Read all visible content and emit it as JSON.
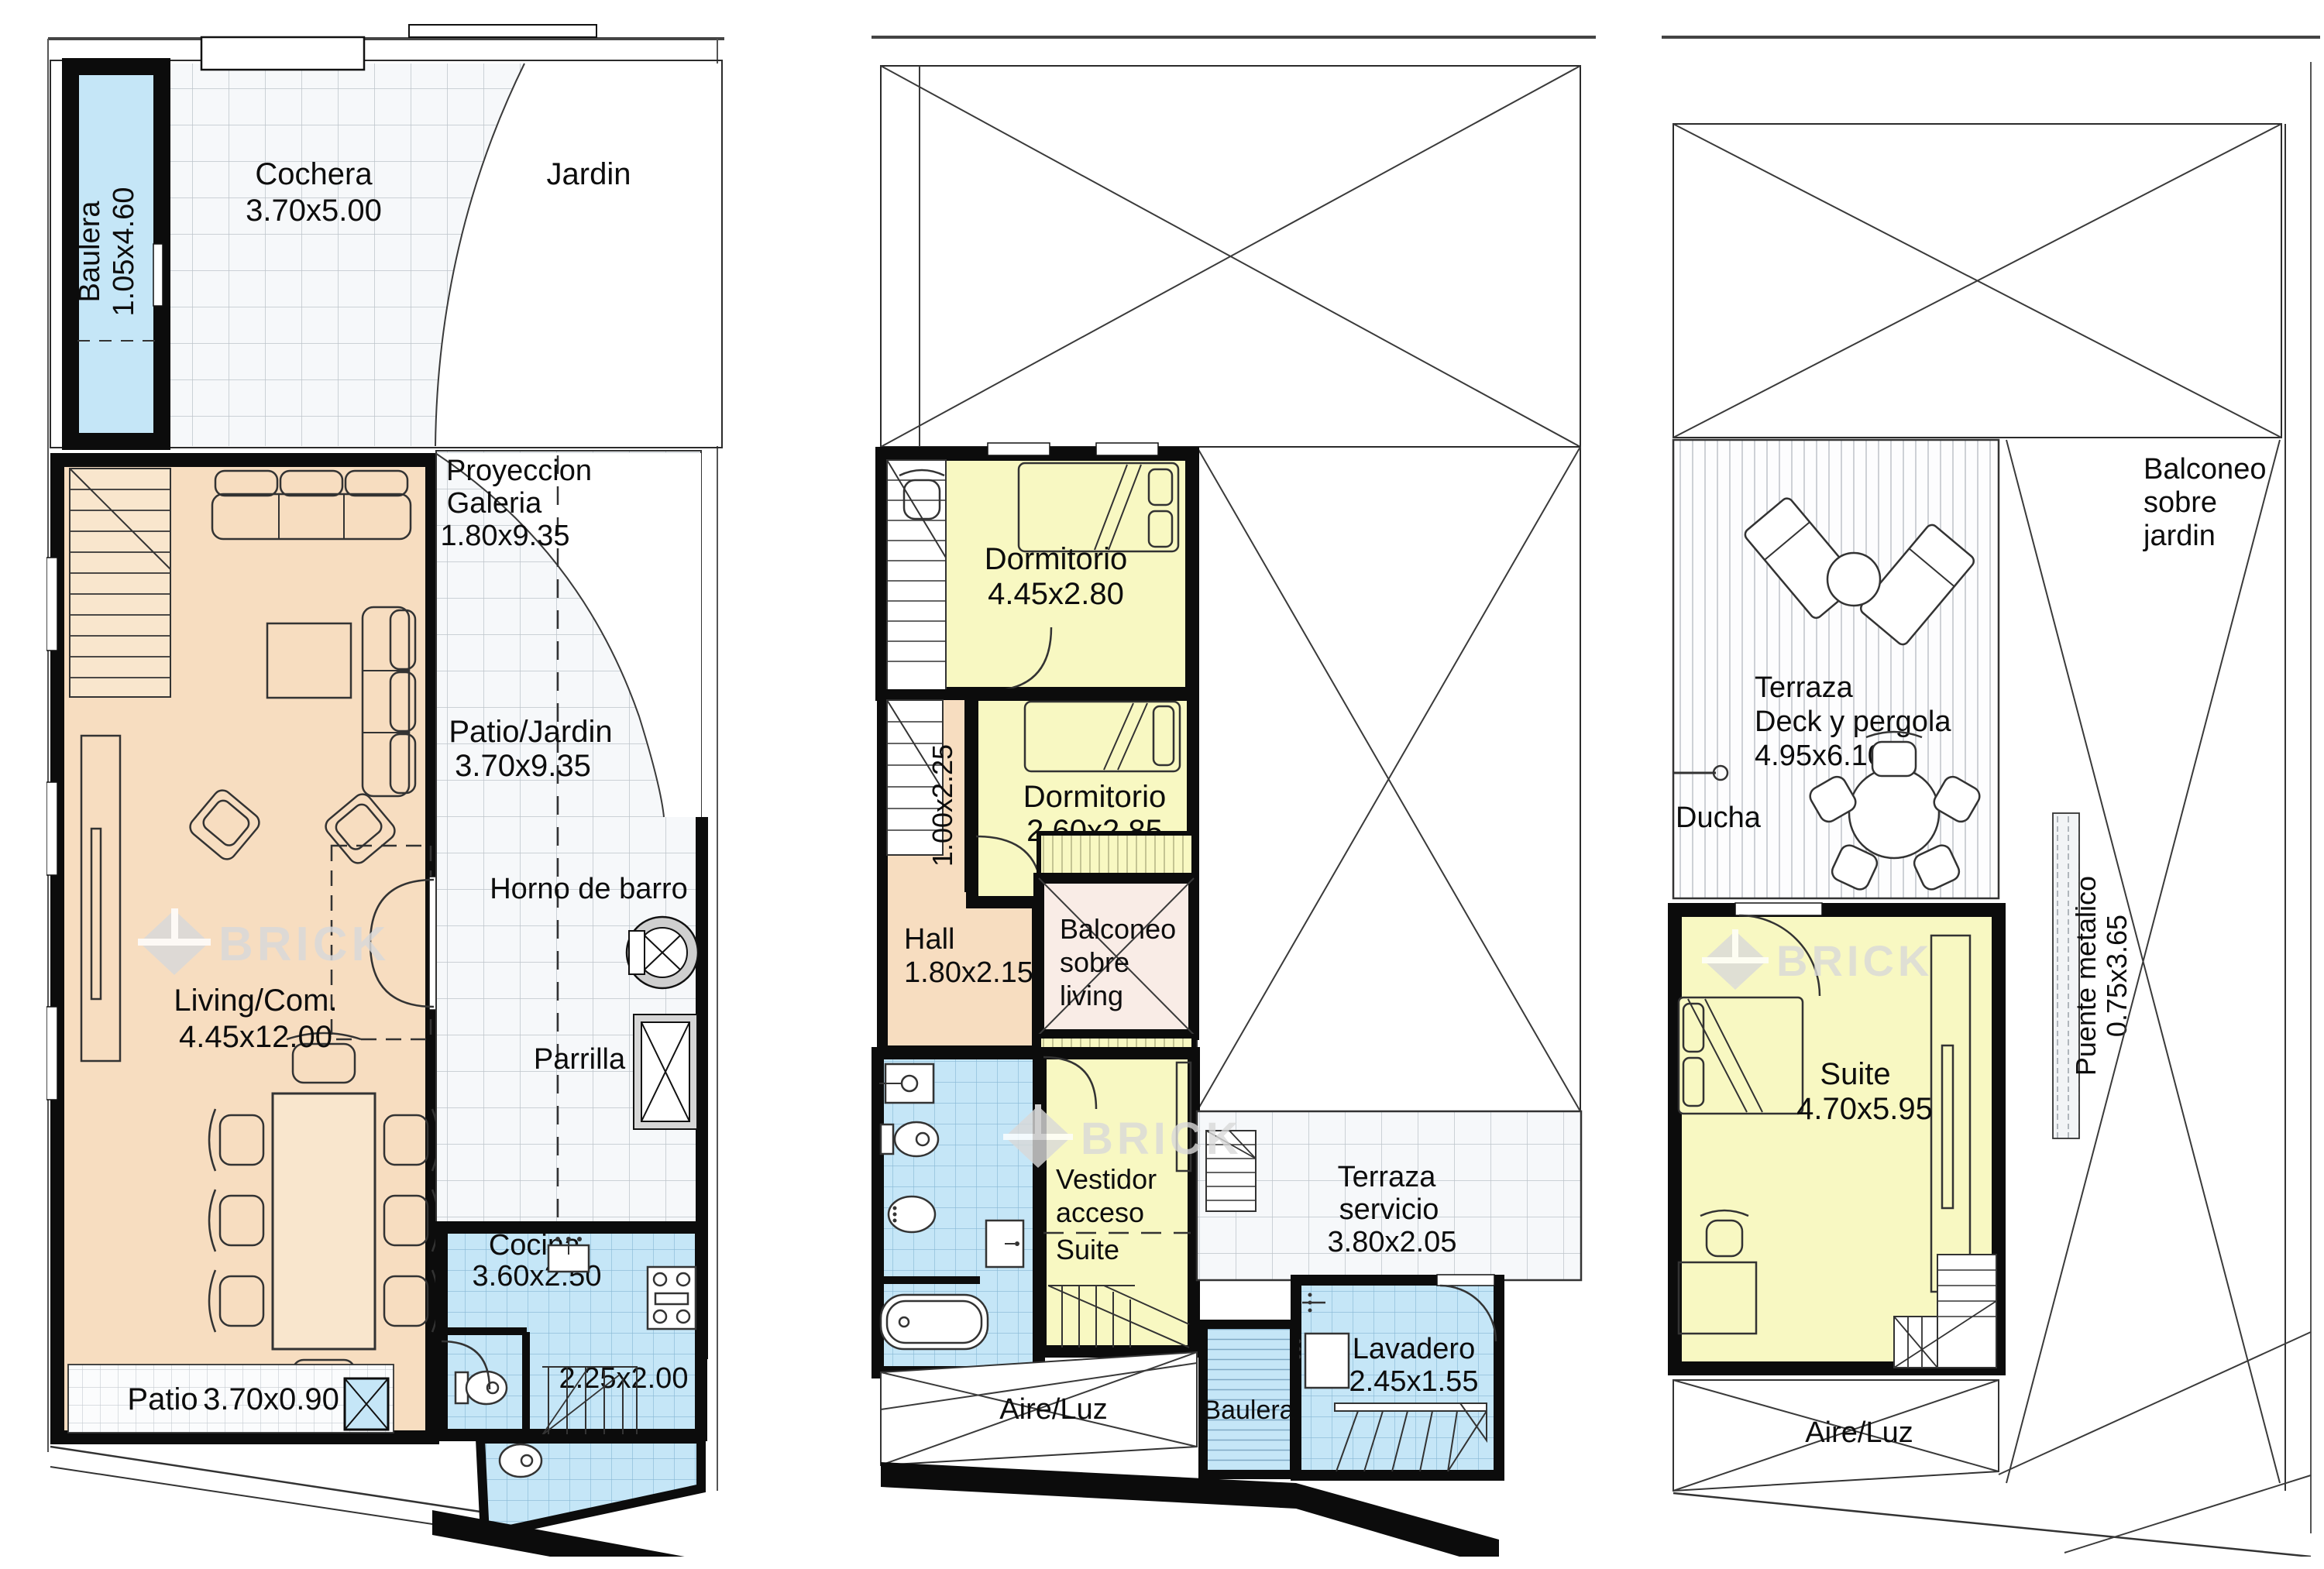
{
  "title": "Floor plans (3 levels) - BRICK",
  "watermark": "BRICK",
  "colors": {
    "wall": "#0c0c0c",
    "peach": "#f7ddc0",
    "yellow": "#f8f8c2",
    "blue": "#c5e6f7",
    "pink": "#f9ece6",
    "tile": "#f6f8fa",
    "watermark": "#d9d9d9"
  },
  "plan1": {
    "baulera_name": "Baulera",
    "baulera_dims": "1.05x4.60",
    "cochera_name": "Cochera",
    "cochera_dims": "3.70x5.00",
    "jardin_name": "Jardin",
    "proyeccion_l1": "Proyeccion",
    "proyeccion_l2": "Galeria",
    "proyeccion_dims": "1.80x9.35",
    "patiojardin_name": "Patio/Jardin",
    "patiojardin_dims": "3.70x9.35",
    "living_name": "Living/Com.",
    "living_dims": "4.45x12.00",
    "horno_name": "Horno de barro",
    "parrilla_name": "Parrilla",
    "cocina_name": "Cocina",
    "cocina_dims": "3.60x2.50",
    "stairroom_dims": "2.25x2.00",
    "patio_name": "Patio",
    "patio_dims": "3.70x0.90"
  },
  "plan2": {
    "dorm1_name": "Dormitorio",
    "dorm1_dims": "4.45x2.80",
    "dorm2_name": "Dormitorio",
    "dorm2_dims": "2.60x2.85",
    "pasillo_dims": "1.00x2.25",
    "hall_name": "Hall",
    "hall_dims": "1.80x2.15",
    "balconeo_l1": "Balconeo",
    "balconeo_l2": "sobre",
    "balconeo_l3": "living",
    "vestidor_l1": "Vestidor",
    "vestidor_l2": "acceso",
    "vestidor_l3": "Suite",
    "terraza_l1": "Terraza",
    "terraza_l2": "servicio",
    "terraza_dims": "3.80x2.05",
    "aireluz": "Aire/Luz",
    "lavadero_name": "Lavadero",
    "lavadero_dims": "2.45x1.55",
    "baulera_name": "Baulera"
  },
  "plan3": {
    "balconeo_l1": "Balconeo",
    "balconeo_l2": "sobre",
    "balconeo_l3": "jardin",
    "terraza_l1": "Terraza",
    "terraza_l2": "Deck y pergola",
    "terraza_dims": "4.95x6.10",
    "ducha_name": "Ducha",
    "suite_name": "Suite",
    "suite_dims": "4.70x5.95",
    "puente_name": "Puente metalico",
    "puente_dims": "0.75x3.65",
    "aireluz": "Aire/Luz"
  }
}
